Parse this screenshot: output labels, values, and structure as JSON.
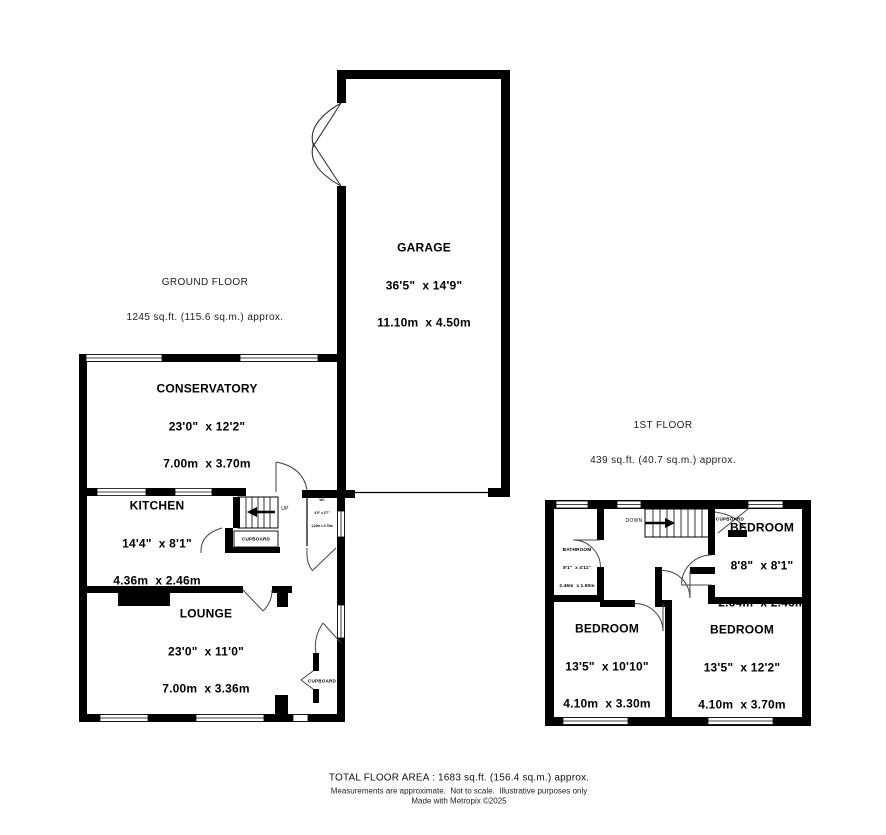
{
  "ground_floor": {
    "title": "GROUND FLOOR",
    "subtitle": "1245 sq.ft. (115.6 sq.m.) approx.",
    "rooms": {
      "garage": {
        "name": "GARAGE",
        "imperial": "36'5\"  x 14'9\"",
        "metric": "11.10m  x 4.50m"
      },
      "conservatory": {
        "name": "CONSERVATORY",
        "imperial": "23'0\"  x 12'2\"",
        "metric": "7.00m  x 3.70m"
      },
      "kitchen": {
        "name": "KITCHEN",
        "imperial": "14'4\"  x 8'1\"",
        "metric": "4.36m  x 2.46m"
      },
      "lounge": {
        "name": "LOUNGE",
        "imperial": "23'0\"  x 11'0\"",
        "metric": "7.00m  x 3.36m"
      },
      "wc": {
        "name": "WC",
        "imperial": "4'0\" x 2'7\"",
        "metric": "1.22m x 0.79m"
      }
    },
    "labels": {
      "up": "UP",
      "cupboard_stairs": "CUPBOARD",
      "cupboard_lounge": "CUPBOARD"
    }
  },
  "first_floor": {
    "title": "1ST FLOOR",
    "subtitle": "439 sq.ft. (40.7 sq.m.) approx.",
    "rooms": {
      "bathroom": {
        "name": "BATHROOM",
        "imperial": "8'1\"  x 4'11\"",
        "metric": "2.46m  x 1.50m"
      },
      "bedroom1": {
        "name": "BEDROOM",
        "imperial": "8'8\"  x 8'1\"",
        "metric": "2.64m  x 2.46m"
      },
      "bedroom2": {
        "name": "BEDROOM",
        "imperial": "13'5\"  x 10'10\"",
        "metric": "4.10m  x 3.30m"
      },
      "bedroom3": {
        "name": "BEDROOM",
        "imperial": "13'5\"  x 12'2\"",
        "metric": "4.10m  x 3.70m"
      }
    },
    "labels": {
      "down": "DOWN",
      "cupboard": "CUPBOARD"
    }
  },
  "footer": {
    "total": "TOTAL FLOOR AREA : 1683 sq.ft. (156.4 sq.m.) approx.",
    "disclaimer": "Measurements are approximate.  Not to scale.  Illustrative purposes only",
    "credit": "Made with Metropix ©2025"
  },
  "colors": {
    "wall": "#000000",
    "background": "#ffffff",
    "door_line": "#444444"
  }
}
